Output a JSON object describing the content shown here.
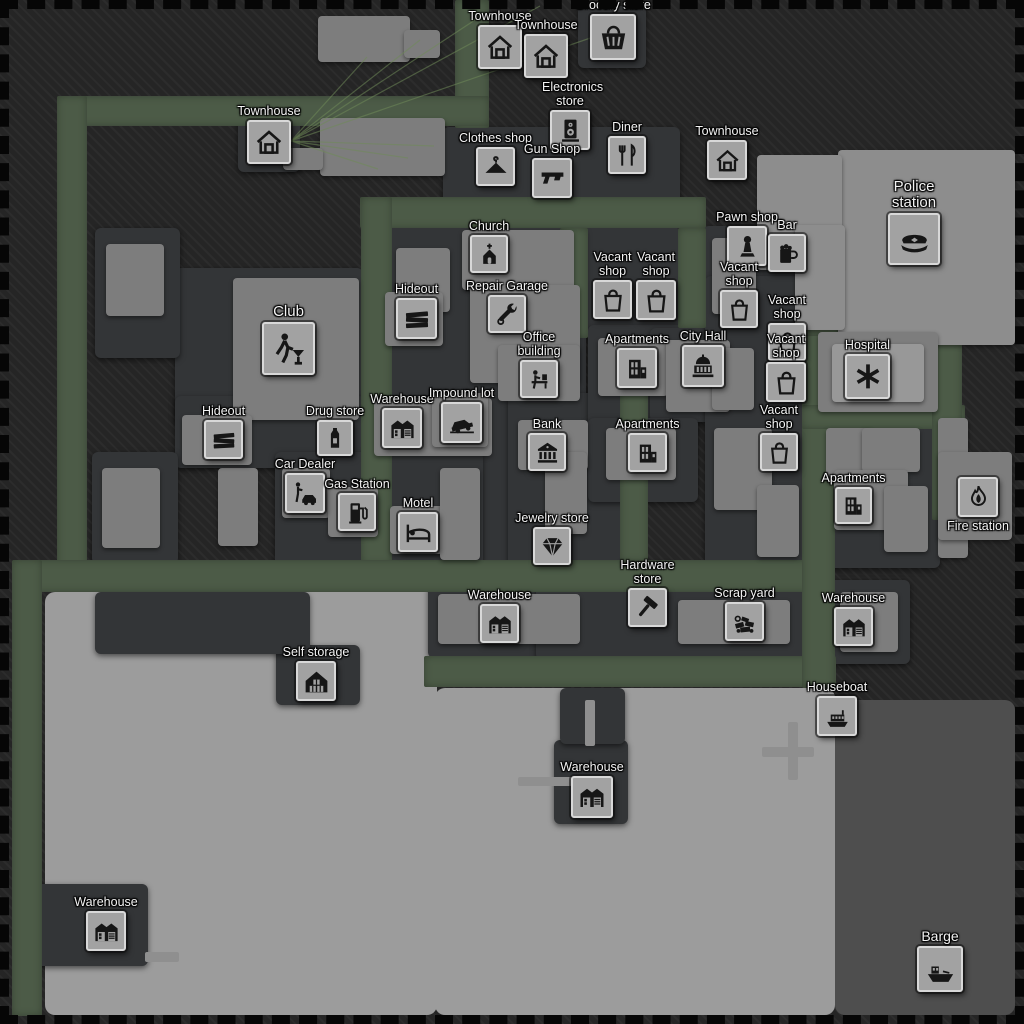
{
  "title": "City map",
  "colors": {
    "background": "#252525",
    "background_stripe": "#2c2c2c",
    "road": "#4c5b47",
    "plot": "#333537",
    "building": "#7d7d7d",
    "building_light": "#8d8d8d",
    "building_lighter": "#989898",
    "bay": "#9c9c9c",
    "bay_dark": "#4e4e4e",
    "dock": "#8f8f8f",
    "tile_bg": "#a2a2a2",
    "tile_border": "#d8d8d8",
    "icon_ink": "#161616",
    "label_text": "#f3f3f3",
    "connection": "#6f8a58"
  },
  "map": {
    "bay": [
      {
        "x": 45,
        "y": 592,
        "w": 392,
        "h": 423,
        "c": "bay"
      },
      {
        "x": 435,
        "y": 688,
        "w": 400,
        "h": 327,
        "c": "bay"
      },
      {
        "x": 835,
        "y": 700,
        "w": 180,
        "h": 315,
        "c": "bay_dark"
      }
    ],
    "roads": [
      {
        "x": 455,
        "y": 0,
        "w": 34,
        "h": 128
      },
      {
        "x": 57,
        "y": 96,
        "w": 432,
        "h": 30
      },
      {
        "x": 57,
        "y": 96,
        "w": 30,
        "h": 476
      },
      {
        "x": 360,
        "y": 197,
        "w": 346,
        "h": 31
      },
      {
        "x": 361,
        "y": 197,
        "w": 31,
        "h": 367
      },
      {
        "x": 560,
        "y": 228,
        "w": 28,
        "h": 110
      },
      {
        "x": 620,
        "y": 336,
        "w": 28,
        "h": 226
      },
      {
        "x": 678,
        "y": 228,
        "w": 28,
        "h": 100
      },
      {
        "x": 12,
        "y": 560,
        "w": 823,
        "h": 32
      },
      {
        "x": 12,
        "y": 560,
        "w": 30,
        "h": 456
      },
      {
        "x": 424,
        "y": 656,
        "w": 412,
        "h": 31
      },
      {
        "x": 802,
        "y": 278,
        "w": 33,
        "h": 410
      },
      {
        "x": 802,
        "y": 312,
        "w": 163,
        "h": 24
      },
      {
        "x": 802,
        "y": 405,
        "w": 163,
        "h": 24
      },
      {
        "x": 932,
        "y": 315,
        "w": 30,
        "h": 205
      }
    ],
    "plots": [
      {
        "x": 443,
        "y": 127,
        "w": 237,
        "h": 96
      },
      {
        "x": 578,
        "y": 6,
        "w": 68,
        "h": 62
      },
      {
        "x": 238,
        "y": 110,
        "w": 62,
        "h": 62
      },
      {
        "x": 703,
        "y": 226,
        "w": 102,
        "h": 110
      },
      {
        "x": 586,
        "y": 224,
        "w": 92,
        "h": 112
      },
      {
        "x": 378,
        "y": 228,
        "w": 208,
        "h": 334
      },
      {
        "x": 175,
        "y": 268,
        "w": 188,
        "h": 156
      },
      {
        "x": 175,
        "y": 396,
        "w": 190,
        "h": 72
      },
      {
        "x": 275,
        "y": 452,
        "w": 208,
        "h": 118
      },
      {
        "x": 508,
        "y": 393,
        "w": 112,
        "h": 180
      },
      {
        "x": 588,
        "y": 325,
        "w": 108,
        "h": 112
      },
      {
        "x": 650,
        "y": 328,
        "w": 96,
        "h": 94
      },
      {
        "x": 588,
        "y": 418,
        "w": 110,
        "h": 84
      },
      {
        "x": 705,
        "y": 276,
        "w": 100,
        "h": 290
      },
      {
        "x": 820,
        "y": 416,
        "w": 120,
        "h": 152
      },
      {
        "x": 428,
        "y": 583,
        "w": 166,
        "h": 75
      },
      {
        "x": 536,
        "y": 583,
        "w": 328,
        "h": 77
      },
      {
        "x": 828,
        "y": 580,
        "w": 82,
        "h": 84
      },
      {
        "x": 276,
        "y": 645,
        "w": 84,
        "h": 60
      },
      {
        "x": 554,
        "y": 740,
        "w": 74,
        "h": 84
      },
      {
        "x": 36,
        "y": 884,
        "w": 112,
        "h": 82
      },
      {
        "x": 95,
        "y": 228,
        "w": 85,
        "h": 130
      },
      {
        "x": 92,
        "y": 452,
        "w": 86,
        "h": 112
      },
      {
        "x": 95,
        "y": 592,
        "w": 215,
        "h": 62
      },
      {
        "x": 560,
        "y": 688,
        "w": 65,
        "h": 56
      }
    ],
    "buildings": [
      {
        "x": 318,
        "y": 16,
        "w": 92,
        "h": 46
      },
      {
        "x": 404,
        "y": 30,
        "w": 36,
        "h": 28
      },
      {
        "x": 320,
        "y": 118,
        "w": 125,
        "h": 58
      },
      {
        "x": 283,
        "y": 148,
        "w": 40,
        "h": 22
      },
      {
        "x": 838,
        "y": 150,
        "w": 177,
        "h": 195,
        "c": "building_light"
      },
      {
        "x": 757,
        "y": 155,
        "w": 85,
        "h": 115,
        "c": "building_light"
      },
      {
        "x": 795,
        "y": 225,
        "w": 50,
        "h": 105,
        "c": "building_light"
      },
      {
        "x": 396,
        "y": 248,
        "w": 54,
        "h": 64
      },
      {
        "x": 462,
        "y": 230,
        "w": 112,
        "h": 60
      },
      {
        "x": 470,
        "y": 285,
        "w": 110,
        "h": 98
      },
      {
        "x": 498,
        "y": 345,
        "w": 82,
        "h": 56
      },
      {
        "x": 385,
        "y": 292,
        "w": 58,
        "h": 54
      },
      {
        "x": 374,
        "y": 398,
        "w": 118,
        "h": 58
      },
      {
        "x": 432,
        "y": 393,
        "w": 56,
        "h": 54
      },
      {
        "x": 233,
        "y": 278,
        "w": 126,
        "h": 142
      },
      {
        "x": 218,
        "y": 468,
        "w": 40,
        "h": 78
      },
      {
        "x": 182,
        "y": 415,
        "w": 70,
        "h": 50
      },
      {
        "x": 282,
        "y": 468,
        "w": 48,
        "h": 50
      },
      {
        "x": 328,
        "y": 487,
        "w": 50,
        "h": 50
      },
      {
        "x": 390,
        "y": 506,
        "w": 58,
        "h": 48
      },
      {
        "x": 440,
        "y": 468,
        "w": 40,
        "h": 92
      },
      {
        "x": 518,
        "y": 420,
        "w": 70,
        "h": 50
      },
      {
        "x": 545,
        "y": 452,
        "w": 42,
        "h": 82
      },
      {
        "x": 598,
        "y": 338,
        "w": 70,
        "h": 58
      },
      {
        "x": 666,
        "y": 340,
        "w": 64,
        "h": 72
      },
      {
        "x": 606,
        "y": 428,
        "w": 70,
        "h": 52
      },
      {
        "x": 712,
        "y": 238,
        "w": 44,
        "h": 76
      },
      {
        "x": 712,
        "y": 348,
        "w": 42,
        "h": 62
      },
      {
        "x": 714,
        "y": 428,
        "w": 58,
        "h": 82
      },
      {
        "x": 757,
        "y": 485,
        "w": 42,
        "h": 72
      },
      {
        "x": 818,
        "y": 332,
        "w": 120,
        "h": 80
      },
      {
        "x": 832,
        "y": 344,
        "w": 92,
        "h": 58,
        "c": "building_lighter"
      },
      {
        "x": 826,
        "y": 428,
        "w": 46,
        "h": 54
      },
      {
        "x": 862,
        "y": 428,
        "w": 58,
        "h": 44
      },
      {
        "x": 834,
        "y": 470,
        "w": 74,
        "h": 60
      },
      {
        "x": 884,
        "y": 486,
        "w": 44,
        "h": 66
      },
      {
        "x": 938,
        "y": 418,
        "w": 30,
        "h": 140
      },
      {
        "x": 938,
        "y": 452,
        "w": 74,
        "h": 88
      },
      {
        "x": 438,
        "y": 594,
        "w": 142,
        "h": 50
      },
      {
        "x": 678,
        "y": 600,
        "w": 112,
        "h": 44
      },
      {
        "x": 840,
        "y": 592,
        "w": 58,
        "h": 60
      },
      {
        "x": 106,
        "y": 244,
        "w": 58,
        "h": 72
      },
      {
        "x": 102,
        "y": 468,
        "w": 58,
        "h": 80
      }
    ],
    "docks": [
      {
        "x": 762,
        "y": 747,
        "w": 52,
        "h": 10
      },
      {
        "x": 788,
        "y": 722,
        "w": 10,
        "h": 58
      },
      {
        "x": 518,
        "y": 777,
        "w": 54,
        "h": 9
      },
      {
        "x": 585,
        "y": 700,
        "w": 10,
        "h": 46
      },
      {
        "x": 145,
        "y": 952,
        "w": 34,
        "h": 10
      }
    ],
    "connections": {
      "from": {
        "x": 291,
        "y": 141
      },
      "to": [
        [
          367,
          57
        ],
        [
          420,
          40
        ],
        [
          478,
          18
        ],
        [
          540,
          6
        ],
        [
          602,
          34
        ],
        [
          434,
          146
        ],
        [
          408,
          158
        ],
        [
          378,
          169
        ]
      ]
    }
  },
  "locations": [
    {
      "id": "townhouse-1",
      "label": "Townhouse",
      "icon": "house",
      "x": 478,
      "y": 25,
      "size": 44
    },
    {
      "id": "townhouse-2",
      "label": "Townhouse",
      "icon": "house",
      "x": 524,
      "y": 34,
      "size": 44
    },
    {
      "id": "grocery-store",
      "label": "Grocery store",
      "icon": "basket",
      "x": 590,
      "y": 14,
      "size": 46
    },
    {
      "id": "townhouse-3",
      "label": "Townhouse",
      "icon": "house",
      "x": 247,
      "y": 120,
      "size": 44
    },
    {
      "id": "electronics-store",
      "label": "Electronics store",
      "icon": "speaker",
      "x": 550,
      "y": 110,
      "size": 40,
      "wrap": true
    },
    {
      "id": "clothes-shop",
      "label": "Clothes shop",
      "icon": "hanger",
      "x": 476,
      "y": 147,
      "size": 39
    },
    {
      "id": "gun-shop",
      "label": "Gun Shop",
      "icon": "gun",
      "x": 532,
      "y": 158,
      "size": 40
    },
    {
      "id": "diner",
      "label": "Diner",
      "icon": "dining",
      "x": 608,
      "y": 136,
      "size": 38
    },
    {
      "id": "townhouse-4",
      "label": "Townhouse",
      "icon": "house",
      "x": 707,
      "y": 140,
      "size": 40
    },
    {
      "id": "police-station",
      "label": "Police station",
      "icon": "police",
      "x": 888,
      "y": 213,
      "size": 52,
      "wrap": true,
      "label_size": 15
    },
    {
      "id": "pawn-shop",
      "label": "Pawn shop",
      "icon": "pawn",
      "x": 727,
      "y": 226,
      "size": 40
    },
    {
      "id": "bar",
      "label": "Bar",
      "icon": "beer",
      "x": 768,
      "y": 234,
      "size": 38
    },
    {
      "id": "church",
      "label": "Church",
      "icon": "church",
      "x": 470,
      "y": 235,
      "size": 38
    },
    {
      "id": "hideout-2",
      "label": "Hideout",
      "icon": "planks",
      "x": 396,
      "y": 298,
      "size": 41
    },
    {
      "id": "repair-garage",
      "label": "Repair Garage",
      "icon": "wrench",
      "x": 488,
      "y": 295,
      "size": 38
    },
    {
      "id": "vacant-shop-1",
      "label": "Vacant shop",
      "icon": "bag",
      "x": 593,
      "y": 280,
      "size": 39,
      "wrap": true
    },
    {
      "id": "vacant-shop-2",
      "label": "Vacant shop",
      "icon": "bag",
      "x": 636,
      "y": 280,
      "size": 40,
      "wrap": true
    },
    {
      "id": "vacant-shop-3",
      "label": "Vacant shop",
      "icon": "bag",
      "x": 720,
      "y": 290,
      "size": 38,
      "wrap": true
    },
    {
      "id": "vacant-shop-4",
      "label": "Vacant shop",
      "icon": "bag",
      "x": 768,
      "y": 323,
      "size": 38,
      "wrap": true
    },
    {
      "id": "vacant-shop-5",
      "label": "Vacant shop",
      "icon": "bag",
      "x": 766,
      "y": 362,
      "size": 40,
      "wrap": true
    },
    {
      "id": "club",
      "label": "Club",
      "icon": "dancer",
      "x": 262,
      "y": 322,
      "size": 53,
      "label_size": 15
    },
    {
      "id": "office-building",
      "label": "Office building",
      "icon": "desk",
      "x": 520,
      "y": 360,
      "size": 38,
      "wrap": true
    },
    {
      "id": "apartments-1",
      "label": "Apartments",
      "icon": "building",
      "x": 617,
      "y": 348,
      "size": 40
    },
    {
      "id": "city-hall",
      "label": "City Hall",
      "icon": "capitol",
      "x": 682,
      "y": 345,
      "size": 42
    },
    {
      "id": "hospital",
      "label": "Hospital",
      "icon": "medical",
      "x": 845,
      "y": 354,
      "size": 45
    },
    {
      "id": "hideout-1",
      "label": "Hideout",
      "icon": "planks",
      "x": 204,
      "y": 420,
      "size": 39
    },
    {
      "id": "drug-store",
      "label": "Drug store",
      "icon": "bottle",
      "x": 317,
      "y": 420,
      "size": 36
    },
    {
      "id": "warehouse-1",
      "label": "Warehouse",
      "icon": "warehouse",
      "x": 382,
      "y": 408,
      "size": 40
    },
    {
      "id": "impound-lot",
      "label": "Impound lot",
      "icon": "tow",
      "x": 441,
      "y": 402,
      "size": 41
    },
    {
      "id": "bank",
      "label": "Bank",
      "icon": "bank",
      "x": 528,
      "y": 433,
      "size": 38
    },
    {
      "id": "apartments-2",
      "label": "Apartments",
      "icon": "building",
      "x": 628,
      "y": 433,
      "size": 39
    },
    {
      "id": "vacant-shop-6",
      "label": "Vacant shop",
      "icon": "bag",
      "x": 760,
      "y": 433,
      "size": 38,
      "wrap": true
    },
    {
      "id": "car-dealer",
      "label": "Car Dealer",
      "icon": "dealer",
      "x": 285,
      "y": 473,
      "size": 40
    },
    {
      "id": "gas-station",
      "label": "Gas Station",
      "icon": "pump",
      "x": 338,
      "y": 493,
      "size": 38
    },
    {
      "id": "motel",
      "label": "Motel",
      "icon": "bed",
      "x": 398,
      "y": 512,
      "size": 40
    },
    {
      "id": "jewelry-store",
      "label": "Jewelry store",
      "icon": "gem",
      "x": 533,
      "y": 527,
      "size": 38
    },
    {
      "id": "apartments-3",
      "label": "Apartments",
      "icon": "building",
      "x": 835,
      "y": 487,
      "size": 37
    },
    {
      "id": "fire-station",
      "label": "Fire station",
      "icon": "flame",
      "x": 958,
      "y": 477,
      "size": 40,
      "label_pos": "below"
    },
    {
      "id": "warehouse-2",
      "label": "Warehouse",
      "icon": "warehouse",
      "x": 480,
      "y": 604,
      "size": 39
    },
    {
      "id": "hardware-store",
      "label": "Hardware store",
      "icon": "hammer",
      "x": 628,
      "y": 588,
      "size": 39,
      "wrap": true
    },
    {
      "id": "scrap-yard",
      "label": "Scrap yard",
      "icon": "scrap",
      "x": 725,
      "y": 602,
      "size": 39
    },
    {
      "id": "warehouse-3",
      "label": "Warehouse",
      "icon": "warehouse",
      "x": 834,
      "y": 607,
      "size": 39
    },
    {
      "id": "self-storage",
      "label": "Self storage",
      "icon": "storage",
      "x": 296,
      "y": 661,
      "size": 40
    },
    {
      "id": "houseboat",
      "label": "Houseboat",
      "icon": "houseboat",
      "x": 817,
      "y": 696,
      "size": 40
    },
    {
      "id": "warehouse-4",
      "label": "Warehouse",
      "icon": "warehouse",
      "x": 571,
      "y": 776,
      "size": 42
    },
    {
      "id": "warehouse-5",
      "label": "Warehouse",
      "icon": "warehouse",
      "x": 86,
      "y": 911,
      "size": 40
    },
    {
      "id": "barge",
      "label": "Barge",
      "icon": "ship",
      "x": 917,
      "y": 946,
      "size": 46,
      "label_size": 14
    }
  ]
}
